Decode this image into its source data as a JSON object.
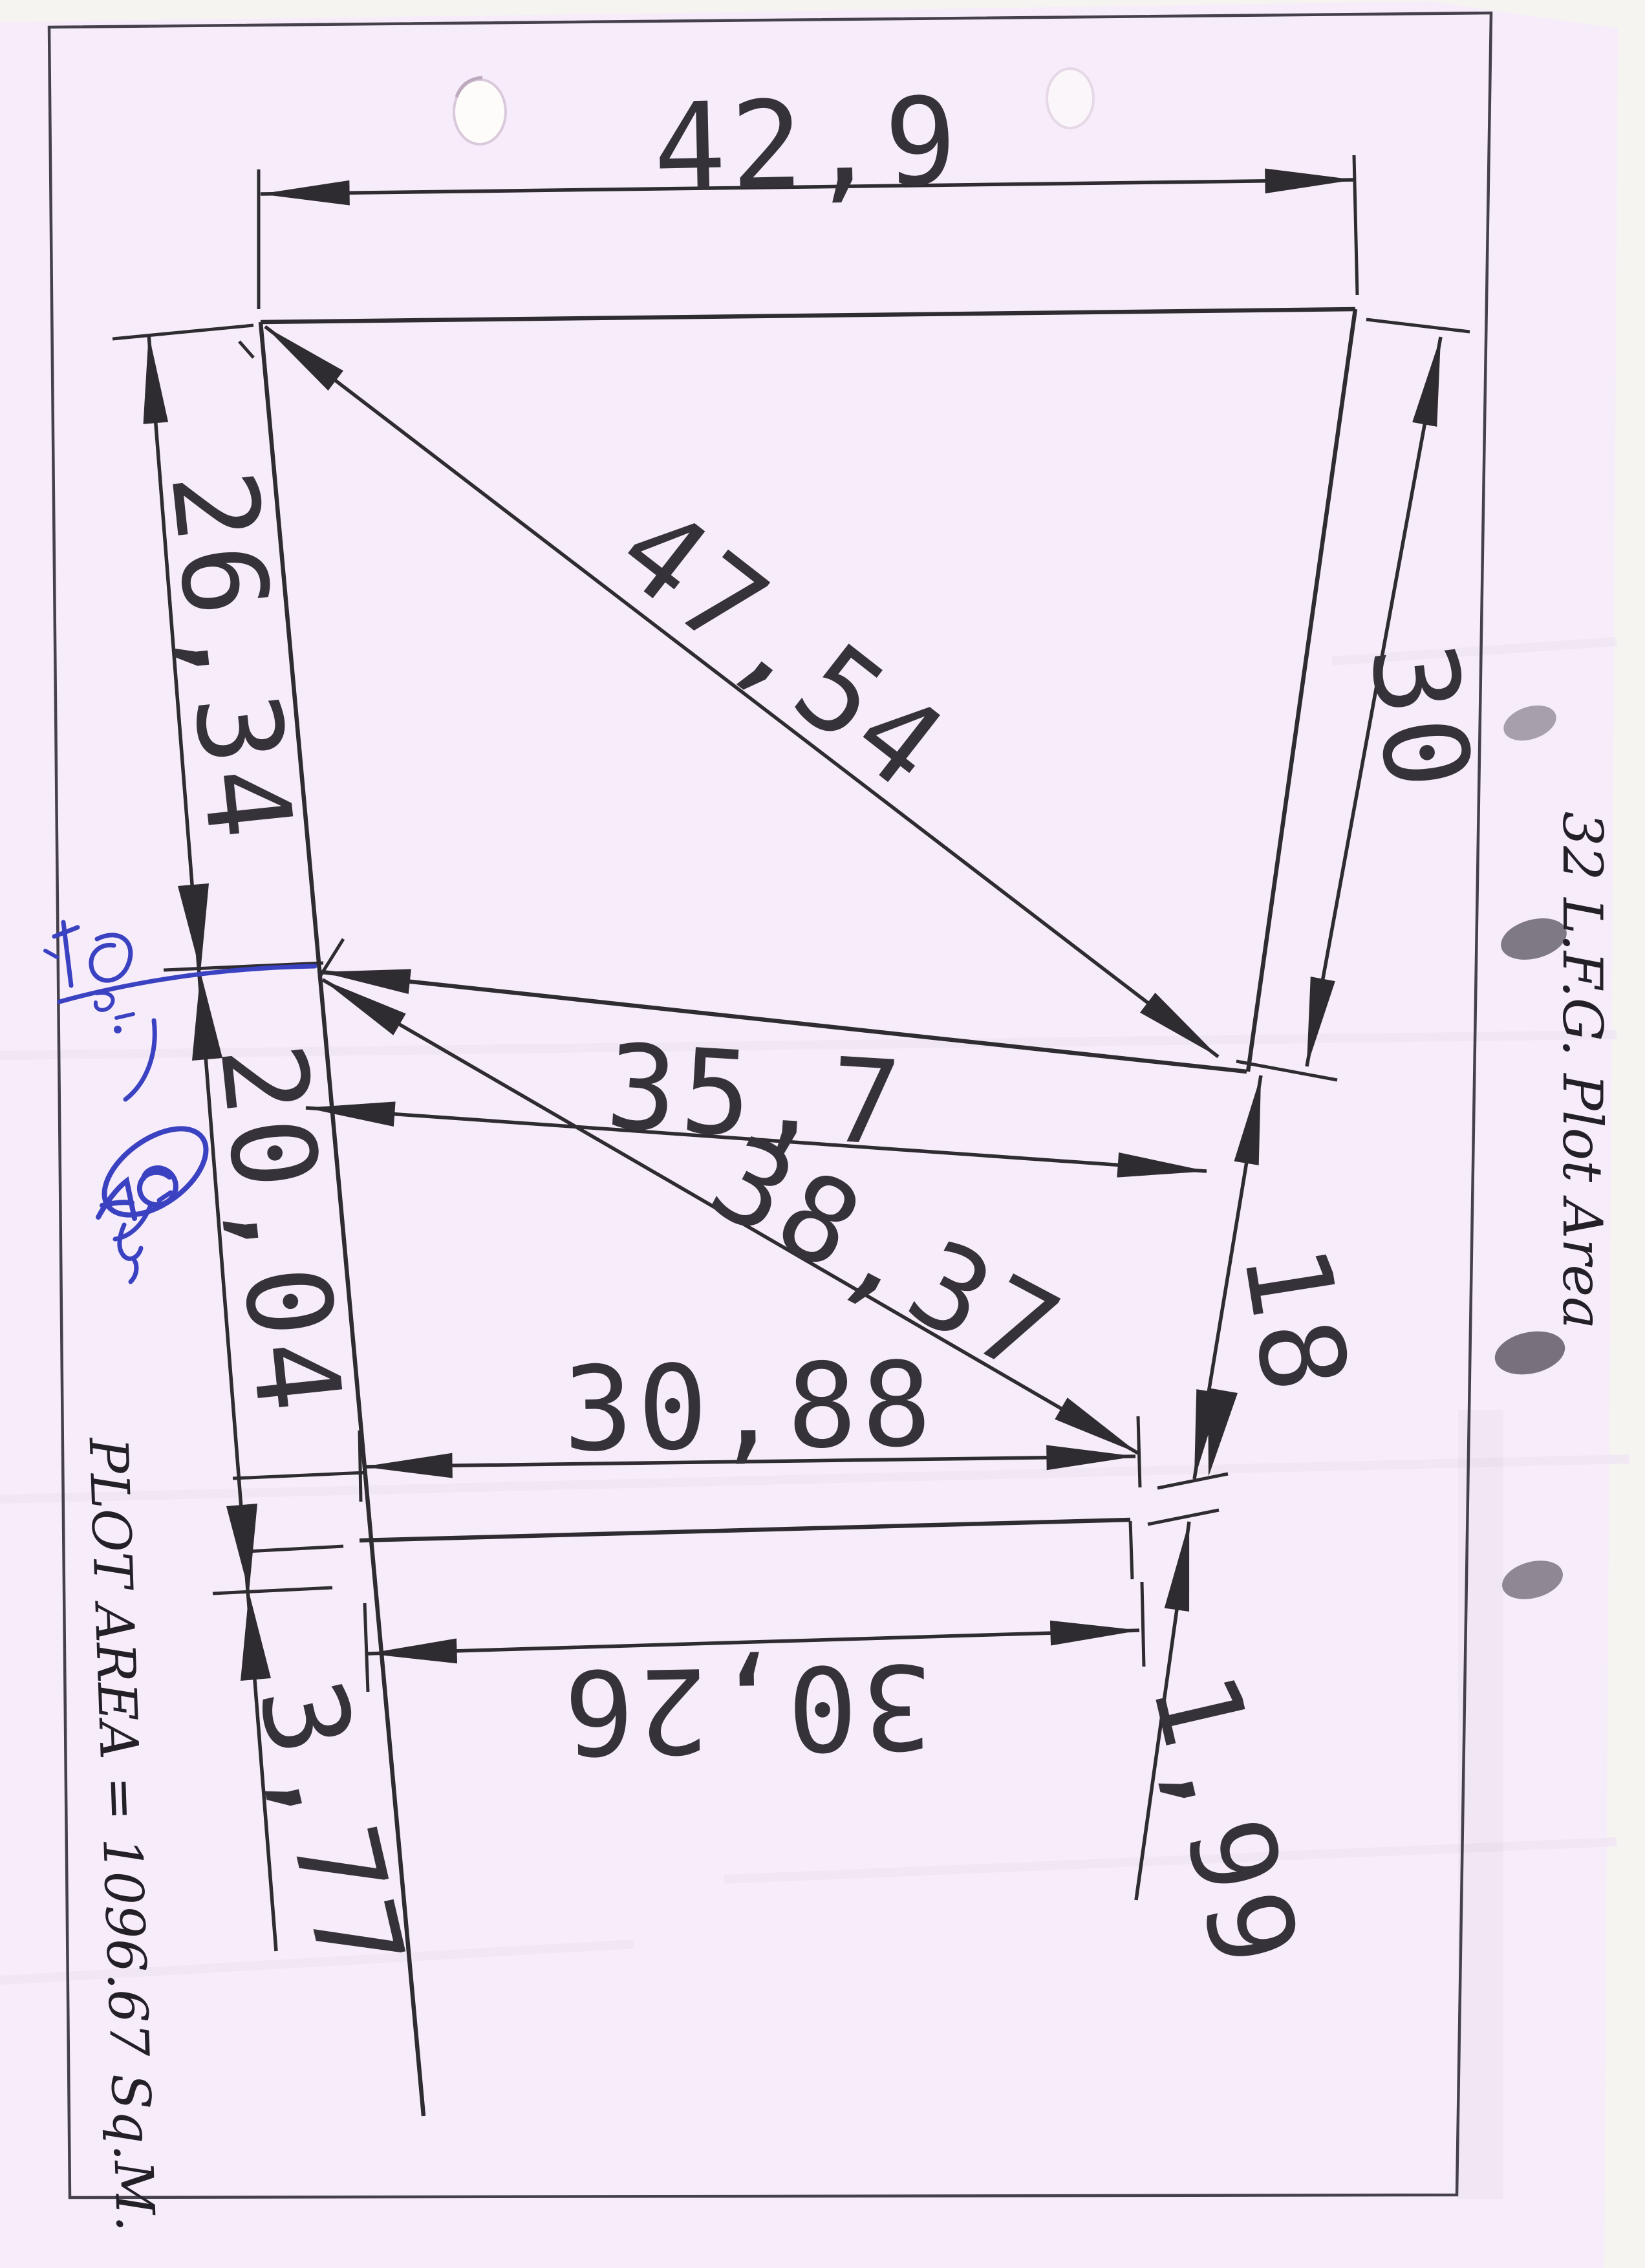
{
  "scan": {
    "paper_color": "#f7ecf9",
    "backdrop_color": "#f6f4f1",
    "ink_color": "#2e2c31",
    "blue_ink_color": "#3a42c2"
  },
  "dimensions": {
    "top_width": "42,9",
    "left_upper": "26,34",
    "main_diagonal": "47,54",
    "right_upper": "30",
    "middle_width": "35,7",
    "middle_diagonal": "38,37",
    "left_middle": "20,04",
    "right_middle": "18",
    "bottom_width_upper": "30,88",
    "bottom_width_lower": "30,26",
    "left_lower": "3,77",
    "right_lower": "1,99"
  },
  "notes": {
    "right_margin": "32 L.F.G. Plot Area",
    "bottom_left": "PLOT AREA = 1096.67 Sq.M."
  }
}
